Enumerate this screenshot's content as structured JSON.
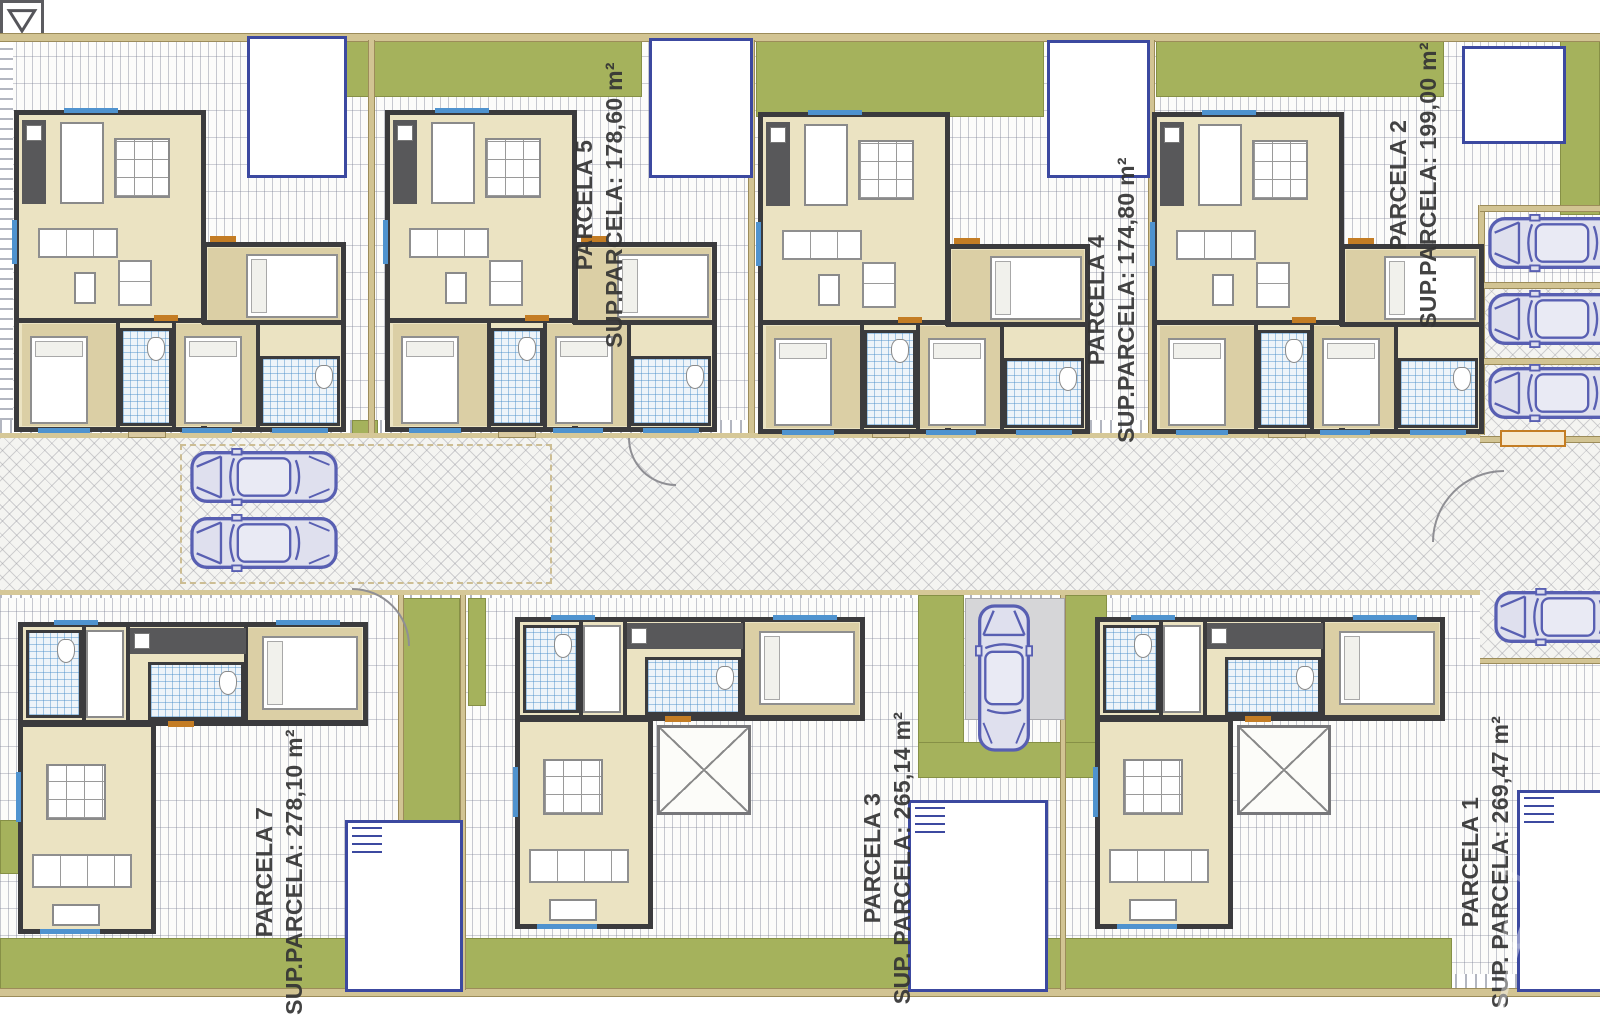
{
  "plan": {
    "title": "Residential development site plan with villa floor plans",
    "parcel_labels": [
      {
        "name": "PARCELA 5",
        "area": "SUP.PARCELA: 178,60 m²",
        "cx": 600,
        "cy": 205
      },
      {
        "name": "PARCELA 4",
        "area": "SUP.PARCELA: 174,80 m²",
        "cx": 1112,
        "cy": 300
      },
      {
        "name": "PARCELA 2",
        "area": "SUP.PARCELA: 199,00 m²",
        "cx": 1414,
        "cy": 185
      },
      {
        "name": "PARCELA 7",
        "area": "SUP.PARCELA: 278,10 m²",
        "cx": 280,
        "cy": 872
      },
      {
        "name": "PARCELA 3",
        "area": "SUP. PARCELA: 265,14 m²",
        "cx": 888,
        "cy": 858
      },
      {
        "name": "PARCELA 1",
        "area": "SUP. PARCELA: 269,47 m²",
        "cx": 1486,
        "cy": 862
      }
    ],
    "colors": {
      "garden_green": "#a5b25c",
      "boundary_tan": "#d2c493",
      "wall_gray": "#3b3b3d",
      "floor_cream": "#ebe3c2",
      "floor_tan": "#dbcfa5",
      "pool_blue": "#3c49a0",
      "car_blue": "#585fb2",
      "door_orange": "#c47d24",
      "tile_blue": "#4f93cf"
    },
    "ground": {
      "hatch_top": [
        0,
        40,
        1600,
        395
      ],
      "hatch_bottom": [
        0,
        588,
        1600,
        402
      ],
      "road": [
        0,
        433,
        1600,
        152
      ],
      "curb_above_road": [
        0,
        420,
        1600,
        13
      ],
      "curb_below_road": [
        0,
        585,
        1600,
        13
      ],
      "curb_left_edge": [
        0,
        40,
        13,
        380
      ],
      "curb_bottom_right": [
        1355,
        974,
        245,
        14
      ],
      "boundary_top": [
        0,
        33,
        1600,
        7
      ],
      "boundary_bottom": [
        0,
        988,
        1600,
        7
      ]
    },
    "greens": [
      [
        342,
        40,
        300,
        57
      ],
      [
        756,
        40,
        288,
        77
      ],
      [
        1156,
        40,
        288,
        57
      ],
      [
        1560,
        40,
        40,
        175
      ],
      [
        0,
        468,
        174,
        40
      ],
      [
        0,
        512,
        174,
        70
      ],
      [
        0,
        938,
        1452,
        52
      ],
      [
        0,
        820,
        48,
        54
      ],
      [
        402,
        598,
        58,
        342
      ],
      [
        468,
        598,
        18,
        108
      ],
      [
        918,
        595,
        46,
        148
      ],
      [
        1065,
        595,
        42,
        148
      ],
      [
        918,
        742,
        190,
        36
      ],
      [
        352,
        420,
        26,
        16
      ]
    ],
    "dividers_v": [
      [
        368,
        40,
        5,
        393
      ],
      [
        748,
        40,
        5,
        393
      ],
      [
        1148,
        40,
        5,
        393
      ],
      [
        1478,
        205,
        5,
        230
      ],
      [
        398,
        595,
        4,
        395
      ],
      [
        460,
        595,
        4,
        395
      ],
      [
        1060,
        595,
        4,
        395
      ]
    ],
    "bay_separators": [
      [
        1480,
        205,
        120,
        5
      ],
      [
        1480,
        282,
        120,
        5
      ],
      [
        1480,
        358,
        120,
        5
      ],
      [
        1480,
        436,
        120,
        5
      ],
      [
        1480,
        658,
        120,
        4
      ]
    ],
    "herring_extra": [
      [
        1480,
        288,
        120,
        148
      ],
      [
        1480,
        590,
        120,
        70
      ]
    ],
    "parking_bay_outline": [
      180,
      444,
      368,
      136
    ],
    "car_pad": [
      965,
      598,
      98,
      120
    ],
    "pools": [
      {
        "x": 247,
        "y": 36,
        "w": 94,
        "h": 136,
        "steps": false
      },
      {
        "x": 649,
        "y": 38,
        "w": 98,
        "h": 134,
        "steps": false
      },
      {
        "x": 1047,
        "y": 40,
        "w": 97,
        "h": 132,
        "steps": false
      },
      {
        "x": 1462,
        "y": 46,
        "w": 98,
        "h": 92,
        "steps": false
      },
      {
        "x": 345,
        "y": 820,
        "w": 112,
        "h": 166,
        "steps": true
      },
      {
        "x": 908,
        "y": 800,
        "w": 134,
        "h": 186,
        "steps": true
      },
      {
        "x": 1517,
        "y": 790,
        "w": 83,
        "h": 196,
        "steps": true
      }
    ],
    "drains": [
      [
        198,
        34
      ],
      [
        598,
        36
      ],
      [
        946,
        34
      ],
      [
        1412,
        36
      ],
      [
        205,
        944
      ],
      [
        806,
        944
      ],
      [
        1108,
        944
      ],
      [
        1400,
        941
      ],
      [
        8,
        828
      ]
    ],
    "houses_top": [
      {
        "x": 14,
        "y": 110
      },
      {
        "x": 385,
        "y": 110
      },
      {
        "x": 758,
        "y": 112
      },
      {
        "x": 1152,
        "y": 112
      }
    ],
    "houses_bottom": [
      {
        "x": 18,
        "y": 622,
        "patio": false
      },
      {
        "x": 515,
        "y": 617,
        "patio": true
      },
      {
        "x": 1095,
        "y": 617,
        "patio": true
      }
    ],
    "cars": [
      {
        "x": 188,
        "y": 448,
        "rot": 0
      },
      {
        "x": 188,
        "y": 514,
        "rot": 0
      },
      {
        "x": 1486,
        "y": 214,
        "rot": 0
      },
      {
        "x": 1486,
        "y": 290,
        "rot": 0
      },
      {
        "x": 1486,
        "y": 364,
        "rot": 0
      },
      {
        "x": 1492,
        "y": 588,
        "rot": 0
      },
      {
        "x": 928,
        "y": 649,
        "rot": 90
      }
    ],
    "entry_steps": [
      [
        128,
        424,
        36,
        12
      ],
      [
        498,
        424,
        36,
        12
      ],
      [
        872,
        424,
        36,
        12
      ],
      [
        1268,
        424,
        36,
        12
      ]
    ],
    "gate_arcs": [
      {
        "x": 628,
        "y": 438,
        "w": 46,
        "h": 46,
        "rot": 0
      },
      {
        "x": 1432,
        "y": 470,
        "w": 70,
        "h": 70,
        "rot": 90
      },
      {
        "x": 352,
        "y": 588,
        "w": 56,
        "h": 56,
        "rot": 180
      }
    ],
    "bench": [
      1500,
      430,
      62,
      13
    ]
  }
}
